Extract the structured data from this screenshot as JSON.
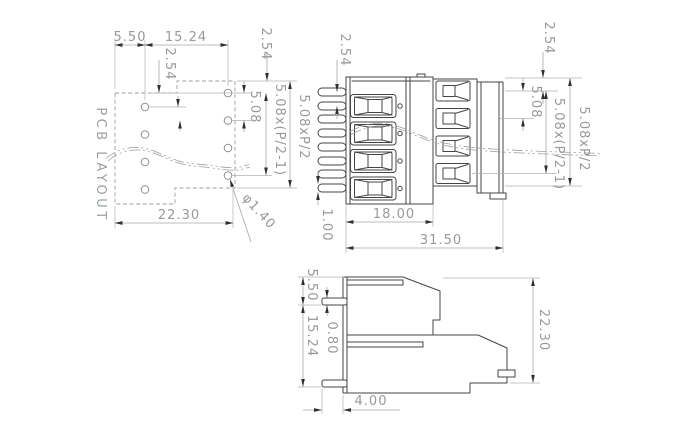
{
  "drawing": {
    "type": "technical-drawing",
    "component": "pcb-terminal-block-connector",
    "colors": {
      "geometry_line": "#454545",
      "dimension_line": "#a6a6a6",
      "dimension_text": "#97999b",
      "background": "#ffffff"
    }
  },
  "labels": {
    "pcb_title": "PCB LAYOUT",
    "pcb": {
      "offset_x": "5.50",
      "span_x": "15.24",
      "stagger": "2.54",
      "pitch": "5.08",
      "row_span": "5.08x(P/2-1)",
      "total_span": "5.08xP/2",
      "top_offset": "2.54",
      "width": "22.30",
      "hole_dia": "φ1.40"
    },
    "front": {
      "pin_pitch": "2.54",
      "pin_size": "1.00",
      "depth": "18.00",
      "total_depth": "31.50",
      "top_offset": "2.54",
      "pitch": "5.08",
      "row_span": "5.08x(P/2-1)",
      "total_span": "5.08xP/2"
    },
    "side": {
      "top_to_pin": "5.50",
      "pin_spacing": "15.24",
      "pin_thickness": "0.80",
      "pin_length": "4.00",
      "height": "22.30"
    }
  }
}
